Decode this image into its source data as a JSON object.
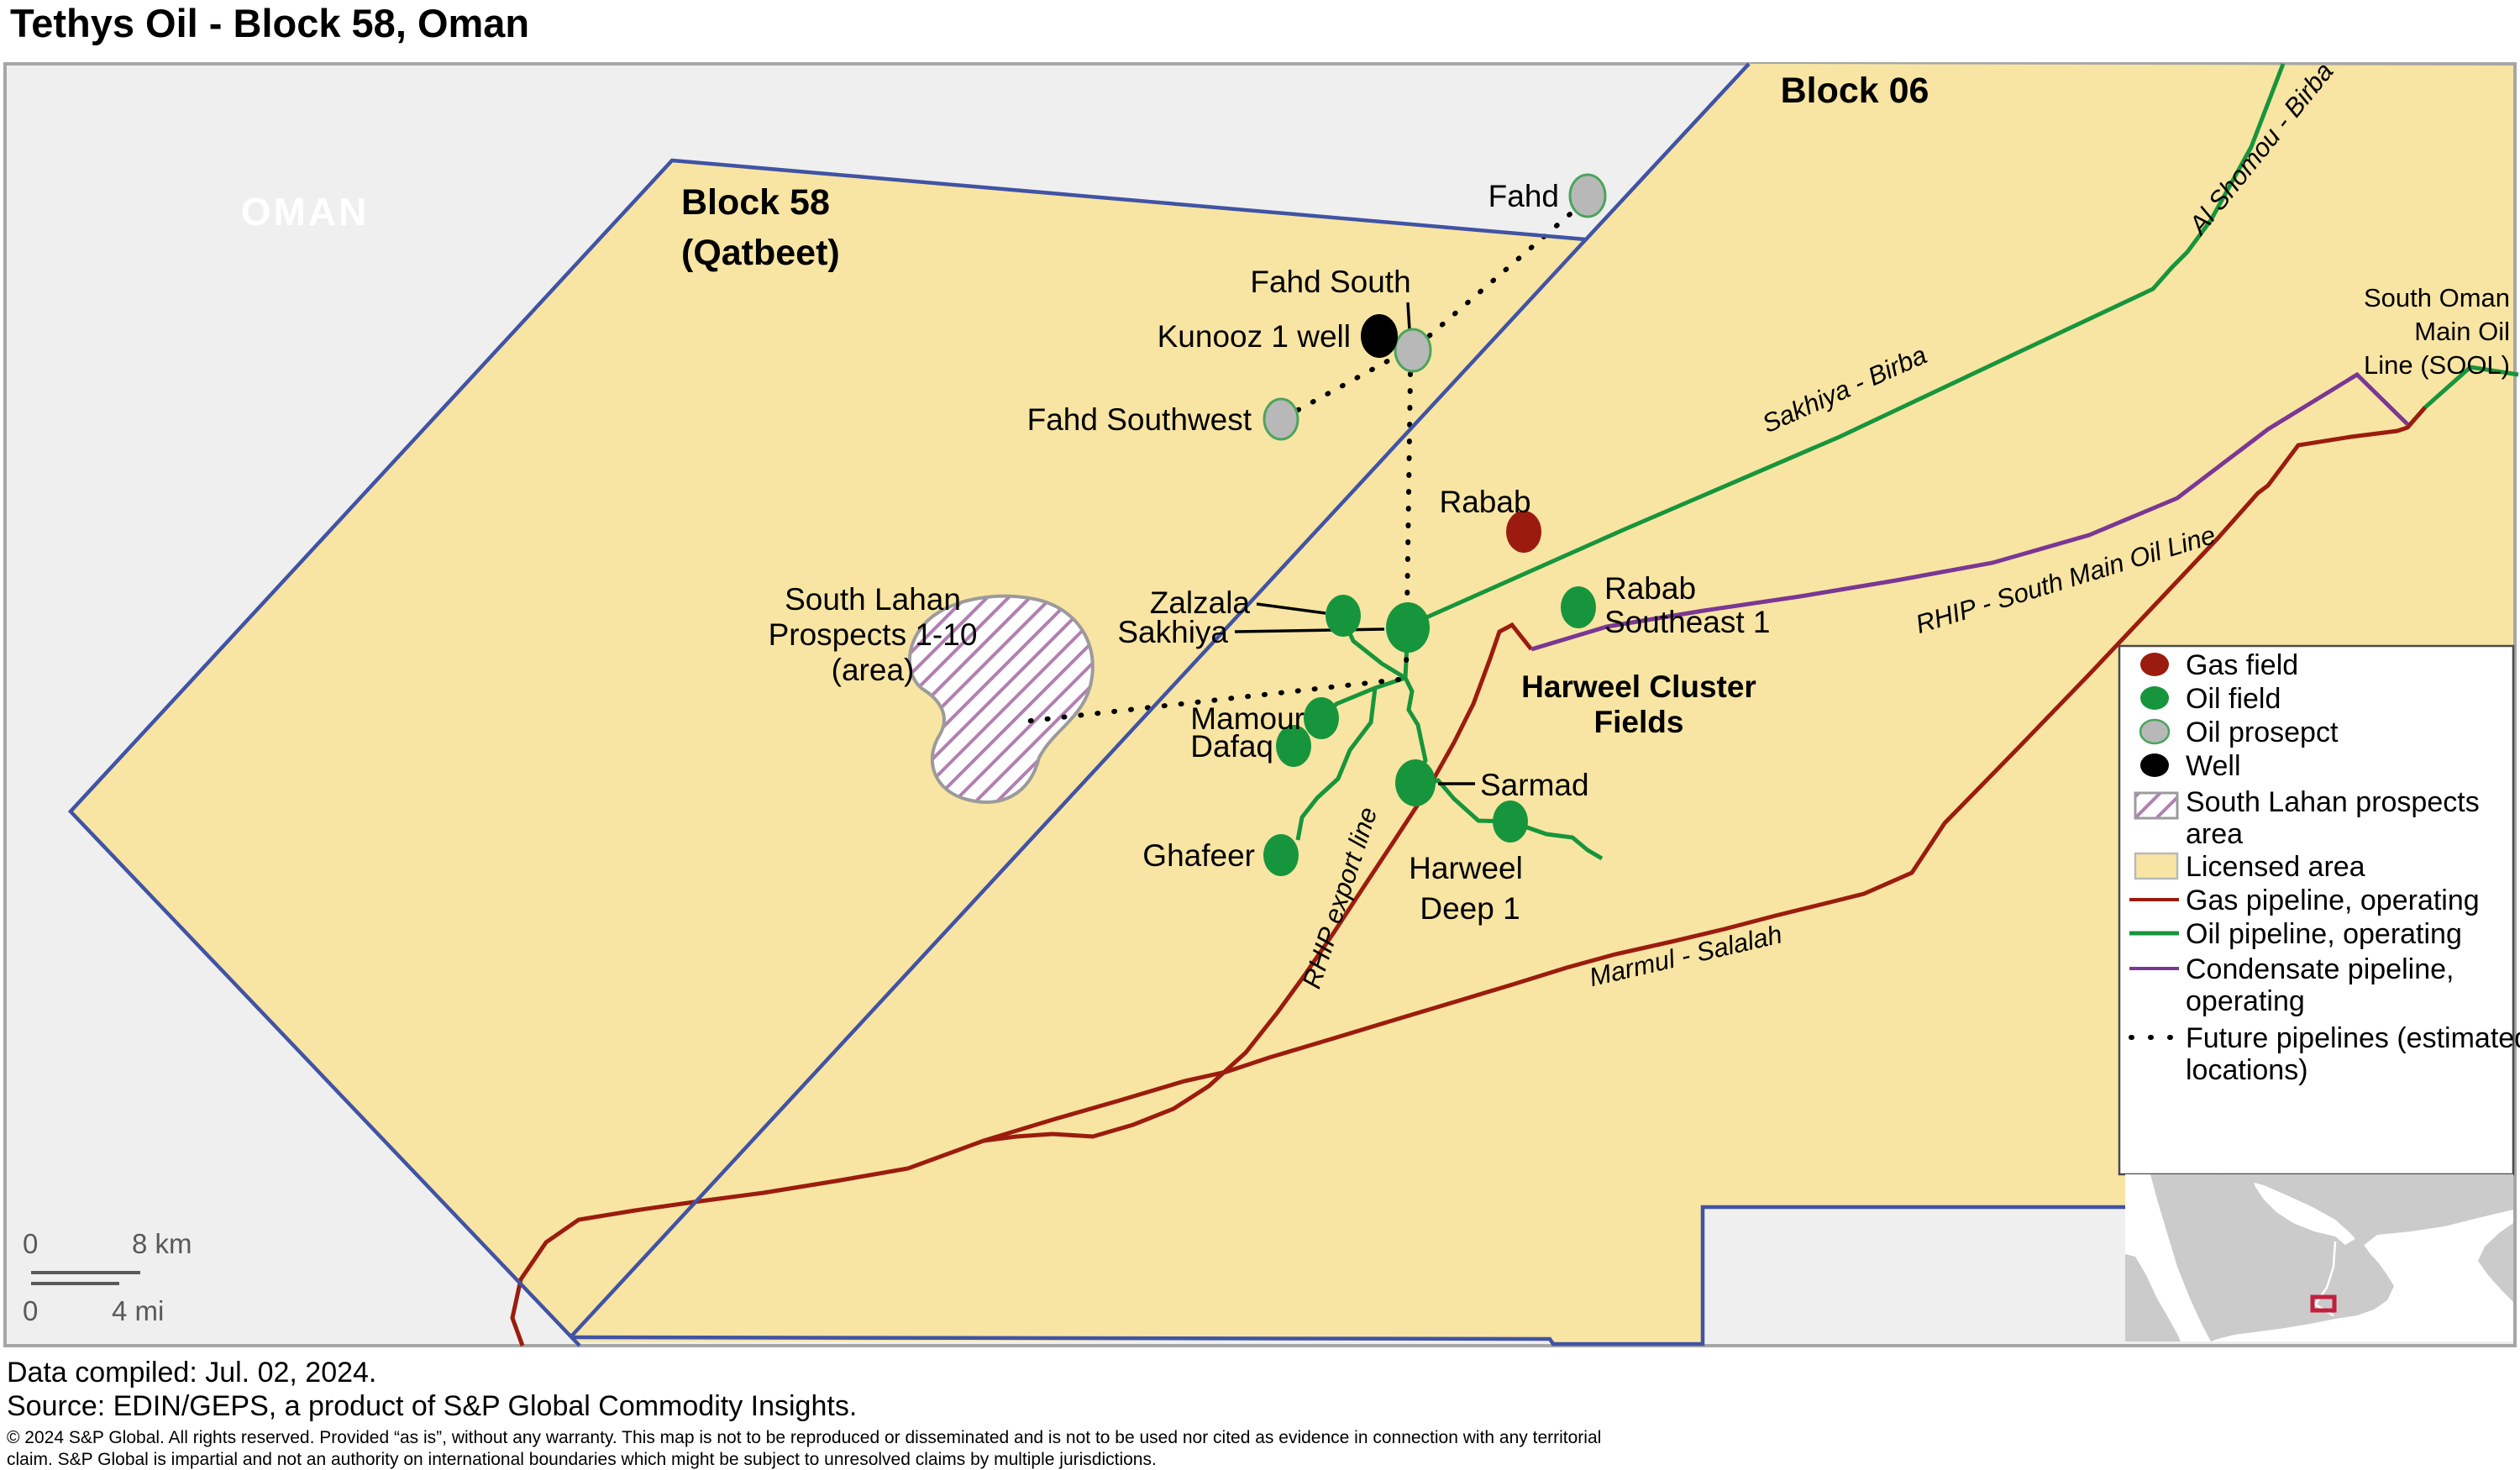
{
  "title": "Tethys Oil - Block 58, Oman",
  "map": {
    "country_label": "OMAN",
    "block58_line1": "Block 58",
    "block58_line2": "(Qatbeet)",
    "block06": "Block 06",
    "fields": {
      "fahd": "Fahd",
      "fahd_south": "Fahd South",
      "kunooz": "Kunooz 1 well",
      "fahd_southwest": "Fahd Southwest",
      "rabab": "Rabab",
      "rabab_se1_line1": "Rabab",
      "rabab_se1_line2": "Southeast 1",
      "zalzala": "Zalzala",
      "sakhiya": "Sakhiya",
      "mamour": "Mamour",
      "dafaq": "Dafaq",
      "ghafeer": "Ghafeer",
      "sarmad": "Sarmad",
      "harweel_deep_line1": "Harweel",
      "harweel_deep_line2": "Deep 1",
      "harweel_cluster_line1": "Harweel Cluster",
      "harweel_cluster_line2": "Fields",
      "south_lahan_line1": "South Lahan",
      "south_lahan_line2": "Prospects 1-10",
      "south_lahan_line3": "(area)"
    },
    "pipelines": {
      "sakhiya_birba": "Sakhiya - Birba",
      "al_shomou_birba": "Al Shomou - Birba",
      "rhip_south": "RHIP - South Main Oil Line",
      "rhip_export": "RHIP export line",
      "marmul_salalah": "Marmul - Salalah",
      "sool_line1": "South Oman",
      "sool_line2": "Main Oil",
      "sool_line3": "Line (SOOL)"
    },
    "scalebar": {
      "km_zero": "0",
      "km_label": "8 km",
      "mi_zero": "0",
      "mi_label": "4 mi"
    }
  },
  "legend": {
    "gas_field": "Gas field",
    "oil_field": "Oil field",
    "oil_prospect": "Oil prosepct",
    "well": "Well",
    "south_lahan_line1": "South Lahan prospects",
    "south_lahan_line2": "area",
    "licensed_area": "Licensed area",
    "gas_pipeline": "Gas pipeline, operating",
    "oil_pipeline": "Oil pipeline, operating",
    "condensate_line1": "Condensate pipeline,",
    "condensate_line2": "operating",
    "future_line1": "Future pipelines (estimated",
    "future_line2": "locations)"
  },
  "footer": {
    "compiled": "Data compiled: Jul. 02, 2024.",
    "source": "Source: EDIN/GEPS, a product of S&P Global Commodity Insights.",
    "fine1": "© 2024 S&P Global. All rights reserved. Provided “as is”, without any warranty. This map is not to be reproduced or disseminated and is not to be used nor cited as evidence in connection with any territorial",
    "fine2": "claim. S&P Global is impartial and not an authority on international boundaries which might be subject to unresolved claims by multiple jurisdictions."
  },
  "colors": {
    "licensed_area": "#F8E5A3",
    "map_background": "#EFEFEF",
    "block_boundary_blue": "#4053A4",
    "gas_red": "#9B1C0E",
    "oil_green": "#17953C",
    "prospect_gray": "#B8B8B8",
    "well_black": "#000000",
    "condensate_purple": "#7A3794",
    "hatch_purple": "#B27FB2",
    "inset_land_gray": "#CBCBCB",
    "inset_marker_red": "#C2203E"
  }
}
